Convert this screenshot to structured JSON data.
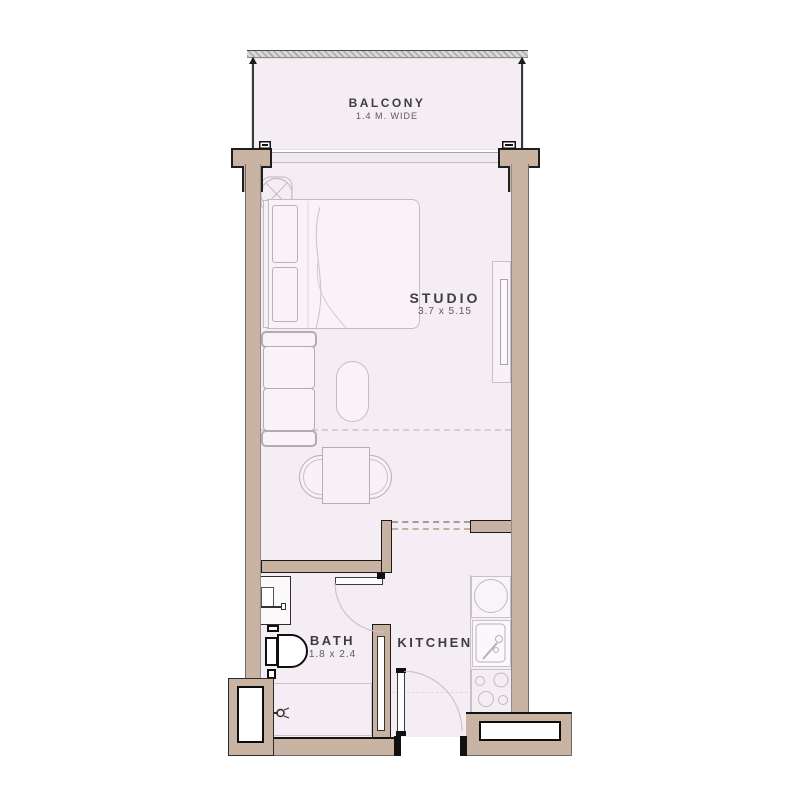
{
  "floorplan": {
    "type": "studio-apartment-floor-plan",
    "rooms": [
      {
        "name": "BALCONY",
        "dims": "1.4 M. WIDE"
      },
      {
        "name": "STUDIO",
        "dims": "3.7 x 5.15"
      },
      {
        "name": "BATH",
        "dims": "1.8 x 2.4"
      },
      {
        "name": "KITCHEN",
        "dims": ""
      }
    ],
    "fixtures": [
      "ceiling-fan",
      "double-bed",
      "sofa",
      "ottoman",
      "dining-table",
      "tv-unit",
      "washbasin",
      "toilet",
      "shower",
      "washing-machine",
      "kitchen-sink",
      "cooktop"
    ],
    "colors": {
      "wall_fill": "#c9b4a4",
      "floor_fill": "#f5edf4",
      "interior_outline": "#1a1a1a",
      "exterior_outline": "#6f696c",
      "furniture_line": "#c3bcc4",
      "railing_gray": "#c7c7c7",
      "text": "#3d3d3d"
    }
  }
}
